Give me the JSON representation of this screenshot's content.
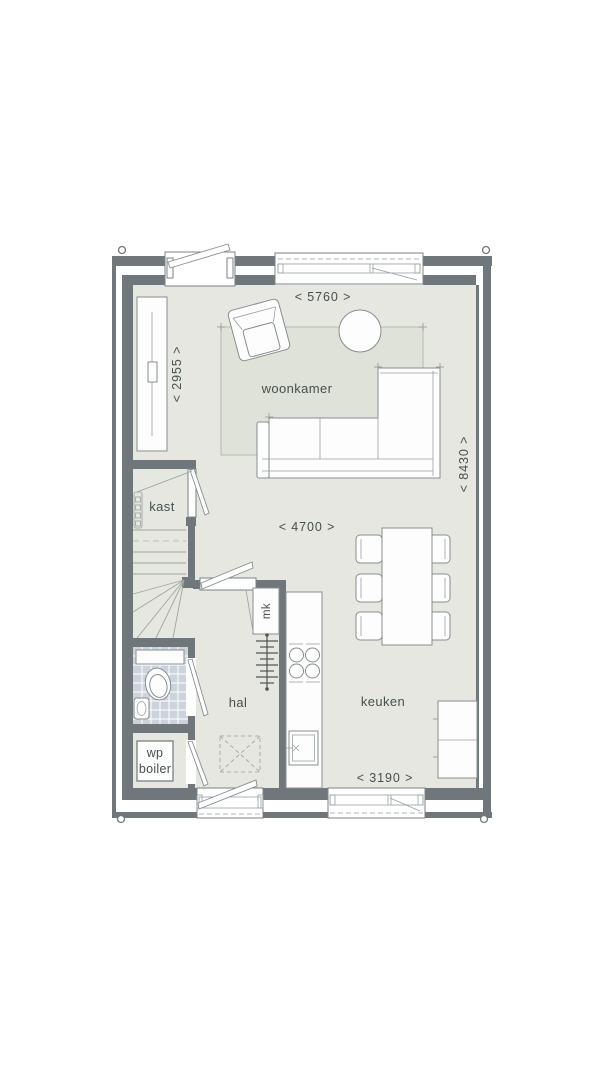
{
  "rooms": {
    "woonkamer": "woonkamer",
    "kast": "kast",
    "hal": "hal",
    "keuken": "keuken",
    "mk": "mk",
    "wp": "wp",
    "boiler": "boiler"
  },
  "dims": {
    "top": "< 5760 >",
    "left": "< 2955 >",
    "middle": "< 4700 >",
    "right": "< 8430 >",
    "bottom": "< 3190 >"
  },
  "colors": {
    "floor": "#e5e7e0",
    "rug": "#dfe2d9",
    "wall": "#6f777a",
    "tile": "#cdd3db",
    "text": "#47504e"
  }
}
